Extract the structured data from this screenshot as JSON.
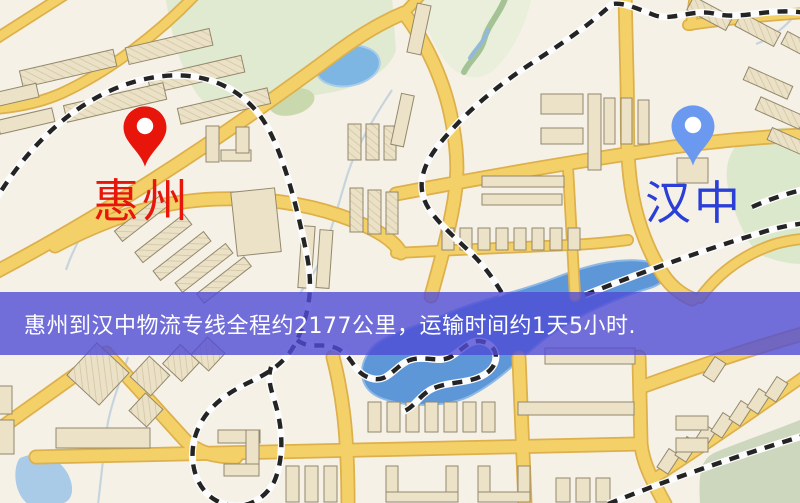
{
  "window": {
    "width": 800,
    "height": 503
  },
  "map": {
    "markers": {
      "origin": {
        "label": "惠州",
        "pin_color": "#e8150b",
        "label_color": "#e8150b"
      },
      "destination": {
        "label": "汉中",
        "pin_color": "#6c99f0",
        "label_color": "#2b3fd6"
      }
    }
  },
  "banner": {
    "text": "惠州到汉中物流专线全程约2177公里，运输时间约1天5小时.",
    "background_color": "#504cd6",
    "text_color": "#ffffff"
  }
}
